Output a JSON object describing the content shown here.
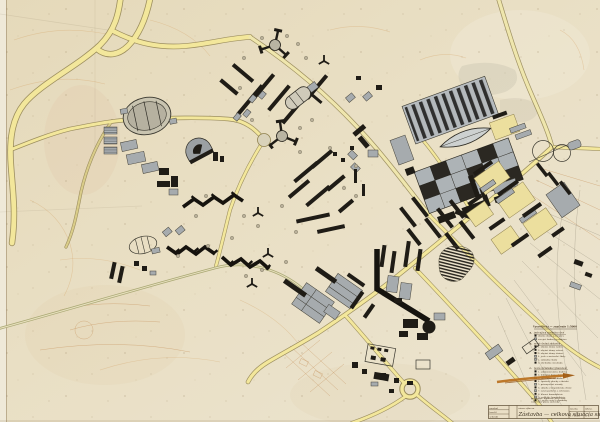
{
  "colors": {
    "paper": "#e8ddc2",
    "road_fill": "#f3e79b",
    "road_edge": "#8f814f",
    "country_road": "#a9a873",
    "building_dark": "#1f1c16",
    "building_gray": "#a6abae",
    "contour_orange": "#cf9452",
    "legend_ink": "#4a3a26",
    "highlight_orange": "#b96f1c"
  },
  "legend": {
    "title": "Vysvetlivky — značenie 1:5000",
    "sections": [
      {
        "marker": "a.",
        "header": "jestvujúca zástavba obce",
        "items": [
          "obytné domy jestvujúce",
          "verejné budovy jestvujúce"
        ]
      },
      {
        "marker": "b.",
        "header": "nová obytná zástavba",
        "items": [
          "1. obytné domy radové",
          "2. obytné domy vežové",
          "3. obytné domy átriové",
          "4. jasle a materské školy",
          "5. základné školy",
          "6. obchodné strediská"
        ]
      },
      {
        "marker": "c.",
        "header": "nová občianska vybavenosť",
        "items": [
          "1. administratívne budovy",
          "2. kultúrny dom a kino",
          "3. zdravotné stredisko",
          "4. športové plochy a ihriská",
          "5. priemyselné závody",
          "6. sklady a hospodárske dvory",
          "7. zeleň parková a ochranná",
          "8. hlavné komunikácie",
          "9. vedľajšie komunikácie",
          "10. pešie cesty a chodníky"
        ]
      }
    ]
  },
  "title_block": {
    "note_line_1": "poznámka: doplnené pri revízii",
    "note_line_2": "celkového plánu zástavby",
    "row_labels": [
      "navrhol",
      "kreslil",
      "schválil"
    ],
    "field_label": "názov výkresu",
    "main_title": "Zástavba — celková situácia sídliska",
    "scale_label": "mierka",
    "scale_value": "1 : 5000",
    "sheet_label": "výkres",
    "sheet_value": "č. 3"
  }
}
